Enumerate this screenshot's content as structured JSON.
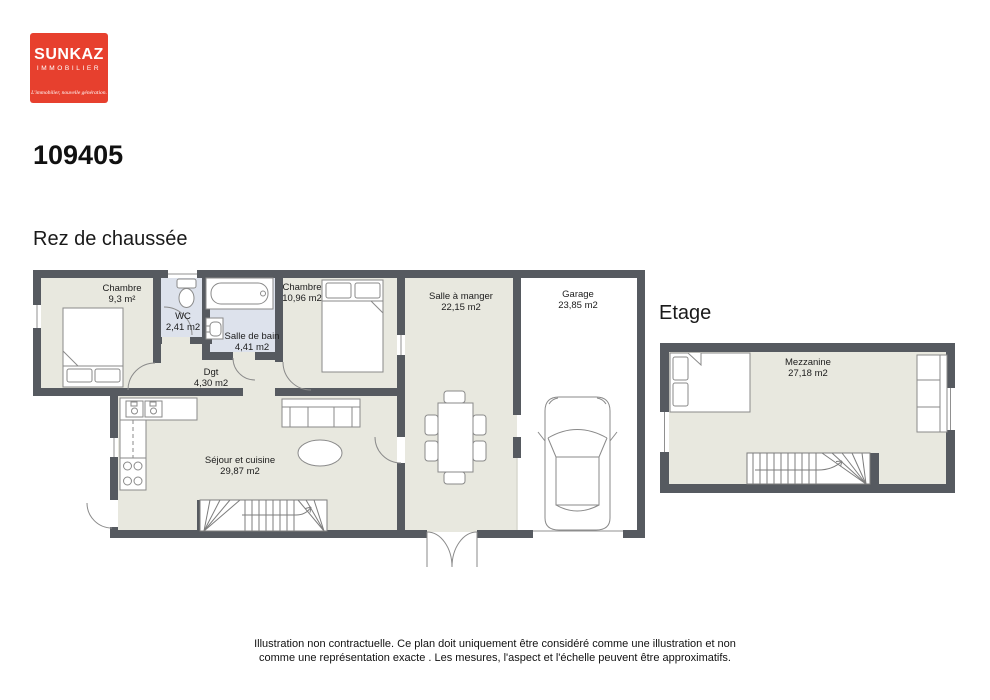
{
  "logo": {
    "brand": "SUNKAZ",
    "subtitle": "IMMOBILIER",
    "tagline": "L'immobilier, nouvelle génération."
  },
  "reference": "109405",
  "ground": {
    "title": "Rez de chaussée",
    "rooms": {
      "chambre1": {
        "name": "Chambre",
        "area": "9,3 m²"
      },
      "wc": {
        "name": "WC",
        "area": "2,41 m2"
      },
      "salle_de_bain": {
        "name": "Salle de bain",
        "area": "4,41 m2"
      },
      "chambre2": {
        "name": "Chambre",
        "area": "10,96 m2"
      },
      "dgt": {
        "name": "Dgt",
        "area": "4,30 m2"
      },
      "sejour": {
        "name": "Séjour et cuisine",
        "area": "29,87 m2"
      },
      "salle_a_manger": {
        "name": "Salle à manger",
        "area": "22,15 m2"
      },
      "garage": {
        "name": "Garage",
        "area": "23,85 m2"
      }
    }
  },
  "upper": {
    "title": "Etage",
    "rooms": {
      "mezzanine": {
        "name": "Mezzanine",
        "area": "27,18 m2"
      }
    }
  },
  "footer": {
    "line1": "Illustration non contractuelle. Ce plan doit uniquement être considéré comme une illustration et non",
    "line2": "comme une représentation exacte . Les mesures, l'aspect et l'échelle peuvent être approximatifs."
  },
  "colors": {
    "wall": "#565a60",
    "floor": "#e8e8df",
    "wet_floor": "#dde2ec",
    "garage_floor": "#ffffff",
    "logo_red": "#e7402e",
    "furniture_stroke": "#8a8a8a"
  }
}
